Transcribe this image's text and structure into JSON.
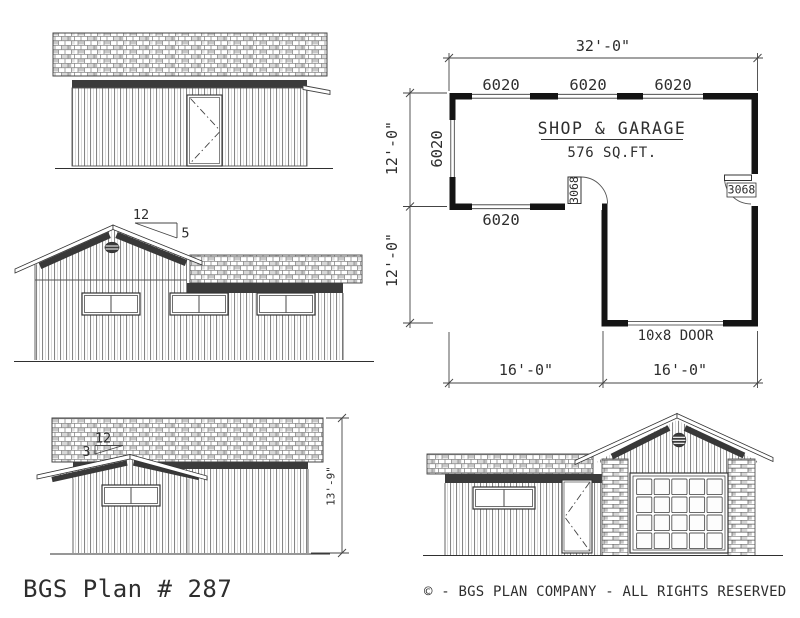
{
  "floor_plan": {
    "title": "SHOP & GARAGE",
    "area": "576 SQ.FT.",
    "dims": {
      "overall_width": "32'-0\"",
      "upper_depth": "12'-0\"",
      "lower_depth": "12'-0\"",
      "bottom_left": "16'-0\"",
      "bottom_right": "16'-0\""
    },
    "windows": {
      "top_1": "6020",
      "top_2": "6020",
      "top_3": "6020",
      "left": "6020",
      "middle": "6020"
    },
    "doors": {
      "interior": "3068",
      "side": "3068",
      "garage": "10x8 DOOR"
    }
  },
  "elevations": {
    "left_side": {
      "pitch_run": "12",
      "pitch_rise": "5"
    },
    "rear": {
      "pitch_run": "12",
      "pitch_rise": "3",
      "height": "13'-9\""
    }
  },
  "footer": {
    "plan_number": "BGS Plan # 287",
    "copyright": "© - BGS PLAN COMPANY - ALL RIGHTS RESERVED"
  }
}
